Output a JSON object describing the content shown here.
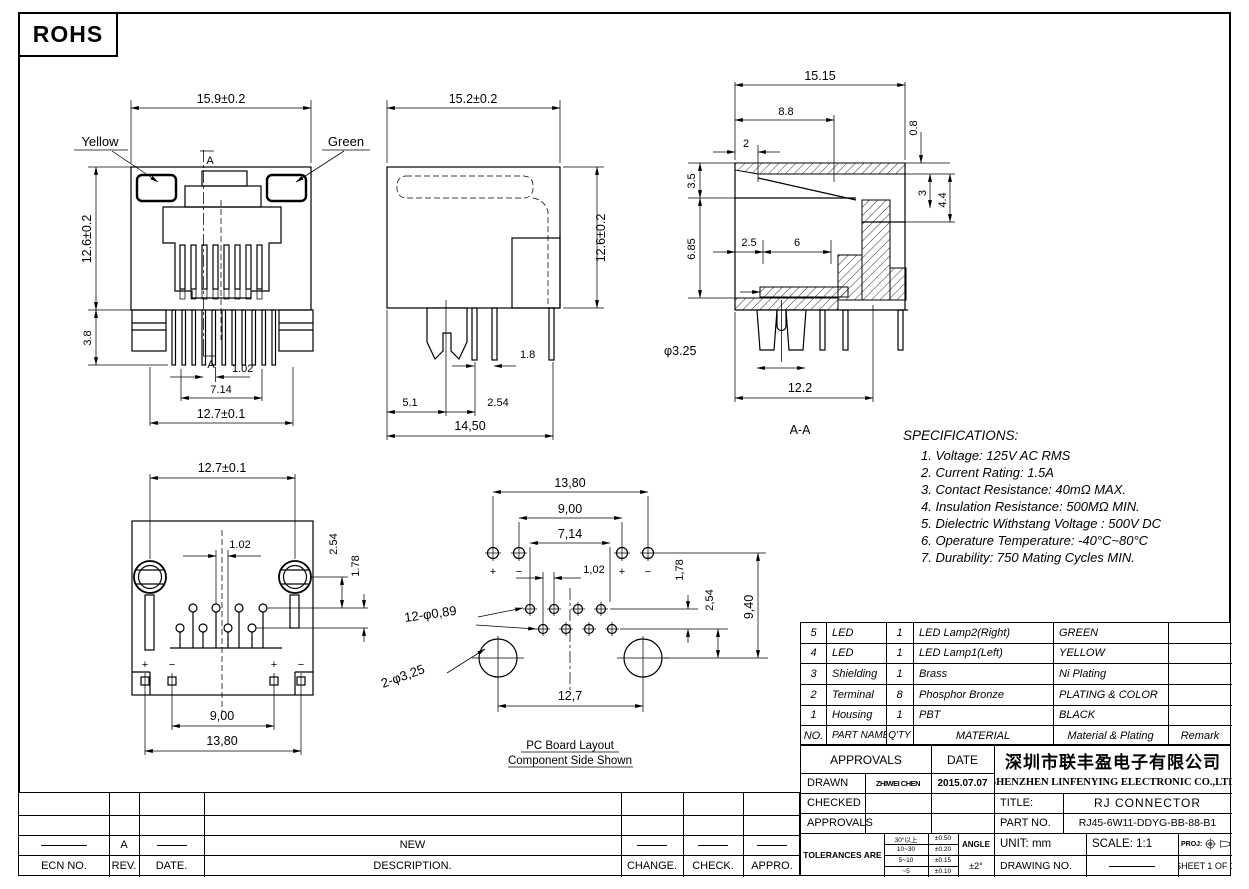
{
  "rohs_label": "ROHS",
  "views": {
    "front": {
      "led_left": "Yellow",
      "led_right": "Green",
      "dim_width": "15.9±0.2",
      "dim_height": "12.6±0.2",
      "dim_pin": "3.8",
      "dim_pitch": "1.02",
      "dim_span": "7.14",
      "dim_total": "12.7±0.1",
      "section_letter": "A"
    },
    "side": {
      "dim_width": "15.2±0.2",
      "dim_height": "12.6±0.2",
      "dim_pin_w": "1.8",
      "dim_a": "5.1",
      "dim_b": "2.54",
      "dim_total": "14,50"
    },
    "section": {
      "dim_width": "15.15",
      "dim_a": "8.8",
      "dim_b": "2",
      "dim_c": "0.8",
      "dim_d": "3.5",
      "dim_e": "3",
      "dim_f": "4.4",
      "dim_g": "6.85",
      "dim_h": "2.5",
      "dim_i": "6",
      "dim_hole": "φ3.25",
      "dim_total": "12.2",
      "label": "A-A"
    },
    "bottom": {
      "dim_total_top": "12.7±0.1",
      "dim_pitch": "1.02",
      "dim_row": "2.54",
      "dim_row2": "1.78",
      "dim_inner": "9,00",
      "dim_outer": "13,80",
      "plus": "+",
      "minus": "−"
    },
    "pcb": {
      "dim_outer": "13,80",
      "dim_inner": "9,00",
      "dim_span": "7,14",
      "dim_pitch": "1,02",
      "dim_r1": "1,78",
      "dim_r2": "2,54",
      "dim_r3": "9,40",
      "dim_bottom": "12,7",
      "callout_small": "12-φ0,89",
      "callout_big": "2-φ3,25",
      "plus": "+",
      "minus": "−",
      "caption1": "PC Board Layout",
      "caption2": "Component Side Shown"
    }
  },
  "specs": {
    "title": "SPECIFICATIONS:",
    "items": [
      "1. Voltage: 125V AC RMS",
      "2. Current Rating: 1.5A",
      "3. Contact Resistance: 40mΩ MAX.",
      "4. Insulation Resistance: 500MΩ MIN.",
      "5. Dielectric Withstang Voltage : 500V DC",
      "6. Operature Temperature: -40°C~80°C",
      "7. Durability: 750 Mating Cycles MIN."
    ]
  },
  "bom": {
    "header": {
      "no": "NO.",
      "part": "PART NAME",
      "qty": "Q'TY",
      "material": "MATERIAL",
      "plating": "Material & Plating",
      "remark": "Remark"
    },
    "rows": [
      {
        "no": "5",
        "part": "LED",
        "qty": "1",
        "material": "LED Lamp2(Right)",
        "plating": "GREEN",
        "remark": ""
      },
      {
        "no": "4",
        "part": "LED",
        "qty": "1",
        "material": "LED Lamp1(Left)",
        "plating": "YELLOW",
        "remark": ""
      },
      {
        "no": "3",
        "part": "Shielding",
        "qty": "1",
        "material": "Brass",
        "plating": "Ni Plating",
        "remark": ""
      },
      {
        "no": "2",
        "part": "Terminal",
        "qty": "8",
        "material": "Phosphor Bronze",
        "plating": "PLATING & COLOR",
        "remark": ""
      },
      {
        "no": "1",
        "part": "Housing",
        "qty": "1",
        "material": "PBT",
        "plating": "BLACK",
        "remark": ""
      }
    ]
  },
  "title_block": {
    "approvals_label": "APPROVALS",
    "date_label": "DATE",
    "drawn_label": "DRAWN",
    "drawn_name": "ZHIWEI CHEN",
    "drawn_date": "2015.07.07",
    "checked_label": "CHECKED",
    "approvals2_label": "APPROVALS",
    "tolerances_label": "TOLERANCES ARE",
    "tolerances": [
      {
        "range": "30°以上",
        "value": "±0.50"
      },
      {
        "range": "10~30",
        "value": "±0.20"
      },
      {
        "range": "5~10",
        "value": "±0.15"
      },
      {
        "range": "~5",
        "value": "±0.10"
      }
    ],
    "angle_label": "ANGLE",
    "angle_value": "±2°",
    "company_cn": "深圳市联丰盈电子有限公司",
    "company_en": "SHENZHEN LINFENYING ELECTRONIC CO.,LTD",
    "title_label": "TITLE:",
    "title_value": "RJ CONNECTOR",
    "part_label": "PART NO.",
    "part_value": "RJ45-6W11-DDYG-BB-88-B1",
    "unit": "UNIT: mm",
    "scale": "SCALE: 1:1",
    "proj_label": "PROJ:",
    "drawing_no_label": "DRAWING NO.",
    "sheet": "SHEET 1 OF 1"
  },
  "revision": {
    "headers": {
      "ecn": "ECN NO.",
      "rev": "REV.",
      "date": "DATE.",
      "desc": "DESCRIPTION.",
      "change": "CHANGE.",
      "check": "CHECK.",
      "appro": "APPRO."
    },
    "row": {
      "rev": "A",
      "desc": "NEW"
    }
  }
}
